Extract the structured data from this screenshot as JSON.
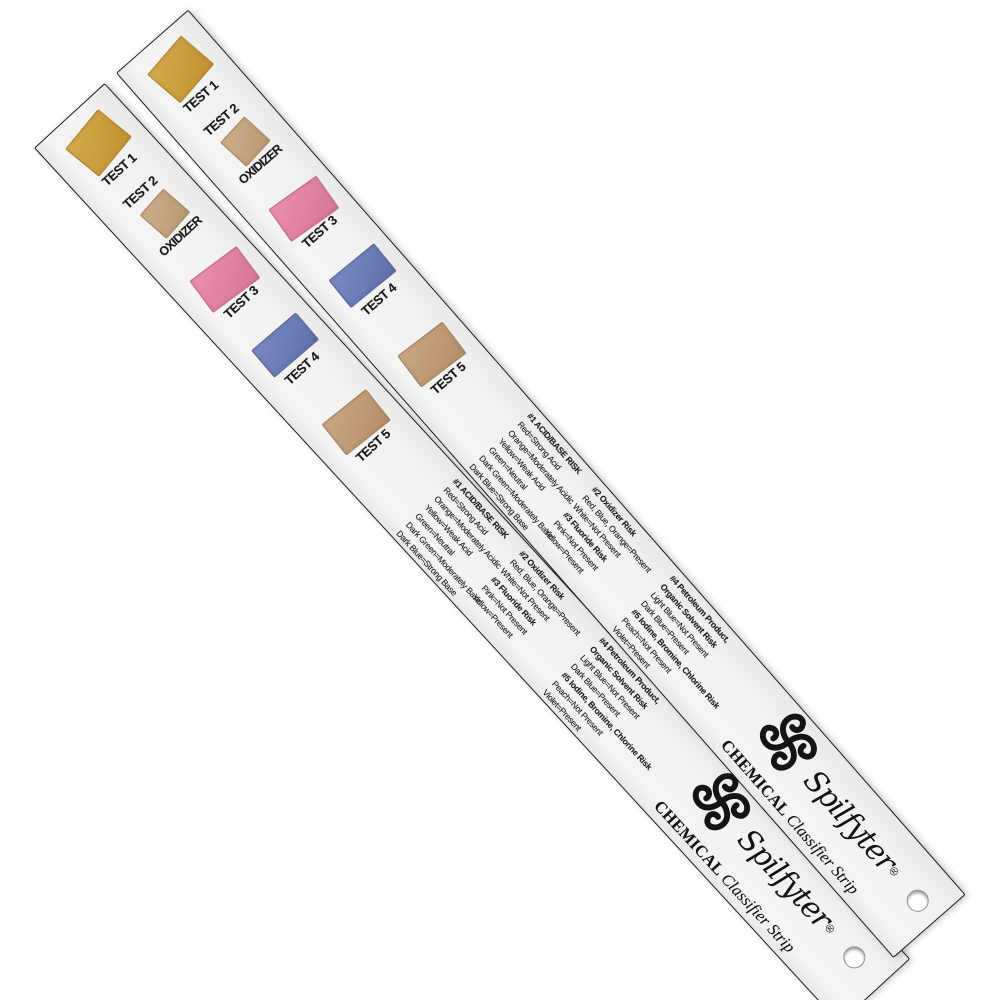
{
  "product": {
    "brand_script": "Spilfyter",
    "brand_reg": "®",
    "series_name_bold": "CHEMICAL",
    "series_name_rest": " Classifier Strip"
  },
  "strip": {
    "patches": [
      {
        "label": "TEST 1",
        "color": "#cf9d31"
      },
      {
        "label": "TEST 2",
        "caption": "OXIDIZER",
        "color": "#c7a37a"
      },
      {
        "label": "TEST 3",
        "color": "#e77ea0"
      },
      {
        "label": "TEST 4",
        "color": "#6577b8"
      },
      {
        "label": "TEST 5",
        "color": "#c2996f"
      }
    ],
    "legend_columns": [
      {
        "lines": [
          {
            "text": "#1 ACID/BASE RISK",
            "bold": true
          },
          {
            "text": "Red=Strong Acid"
          },
          {
            "text": "Orange=Moderately Acidic"
          },
          {
            "text": "Yellow=Weak Acid"
          },
          {
            "text": "Green=Neutral"
          },
          {
            "text": "Dark Green=Moderately Basic"
          },
          {
            "text": "Dark Blue=Strong Base"
          }
        ]
      },
      {
        "lines": [
          {
            "text": "#2 Oxidizer Risk",
            "bold": true
          },
          {
            "text": "Red, Blue, Orange=Present"
          },
          {
            "text": "White=Not Present"
          },
          {
            "text": "#3 Fluoride Risk",
            "bold": true
          },
          {
            "text": "Pink=Not Present"
          },
          {
            "text": "Yellow=Present"
          }
        ]
      },
      {
        "lines": [
          {
            "text": "#4 Petroleum Product,",
            "bold": true
          },
          {
            "text": "Organic Solvent Risk",
            "bold": true
          },
          {
            "text": "Light Blue=Not Present"
          },
          {
            "text": "Dark Blue=Present"
          },
          {
            "text": "#5 Iodine, Bromine, Chlorine Risk",
            "bold": true
          },
          {
            "text": "Peach=Not Present"
          },
          {
            "text": "Violet=Present"
          }
        ]
      }
    ]
  }
}
